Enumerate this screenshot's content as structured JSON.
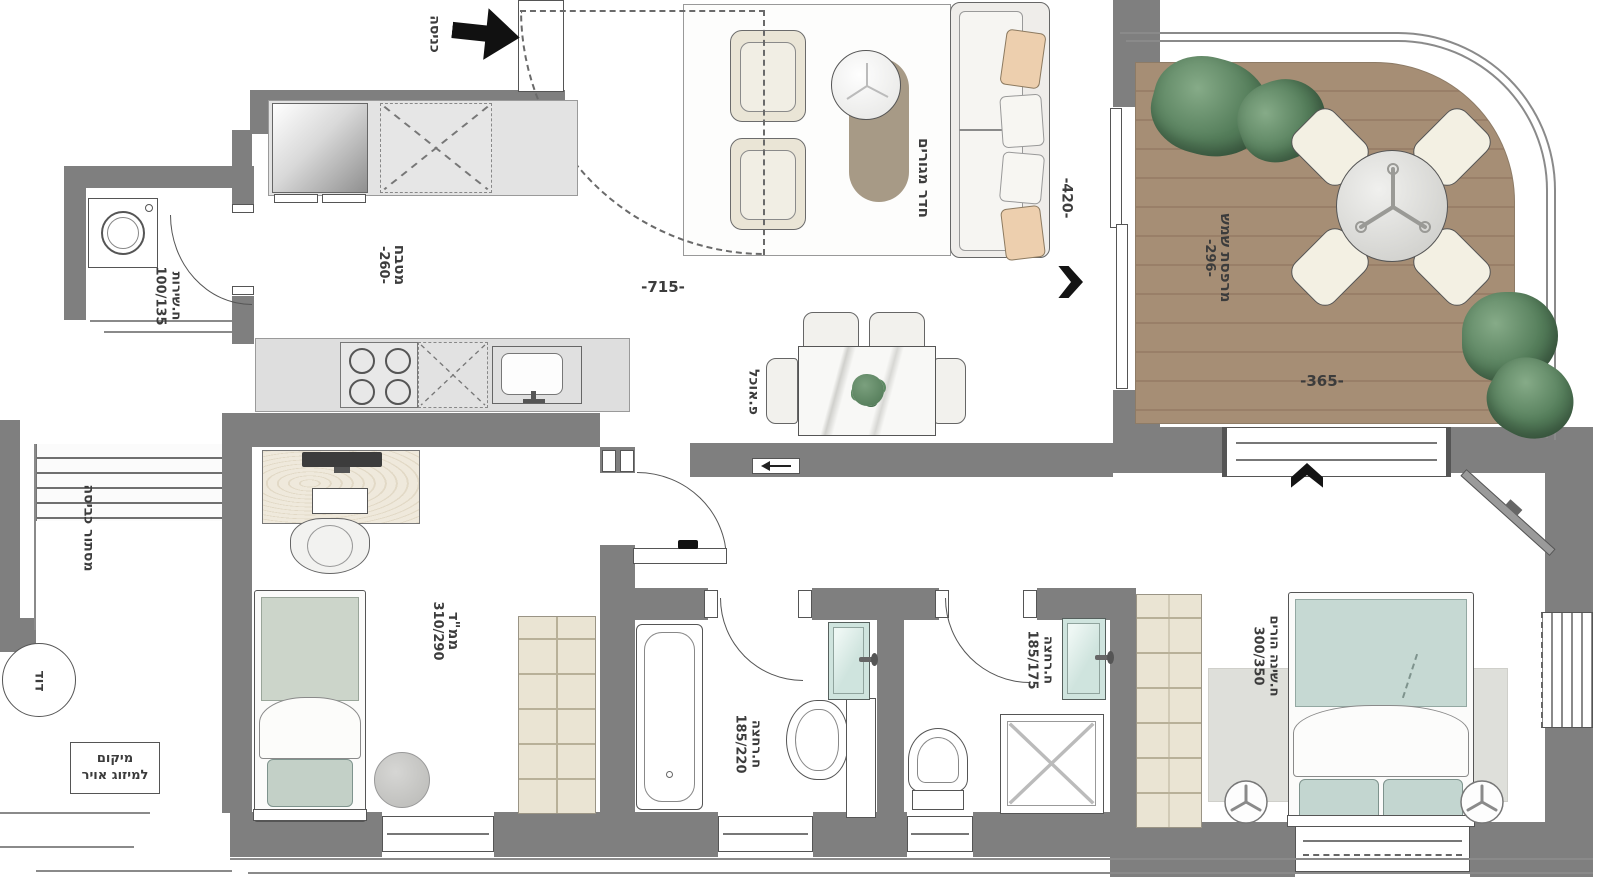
{
  "rooms": {
    "entrance": {
      "name": "כניסה"
    },
    "living": {
      "name": "חדר מגורים",
      "width_dim": "-715-",
      "depth_dim": "-420-"
    },
    "kitchen": {
      "name": "מטבח",
      "dim": "-260-"
    },
    "dining": {
      "name": "פ.אוכל"
    },
    "balcony": {
      "name": "מרפסת שמש",
      "depth_dim": "-296-",
      "width_dim": "-365-"
    },
    "service": {
      "name": "ח.שירות",
      "size": "100/135"
    },
    "laundry": {
      "name": "מסתור כביסה"
    },
    "boiler": {
      "name": "דוד"
    },
    "ac": {
      "line1": "מיקום",
      "line2": "למיזוג אויר"
    },
    "safe_room": {
      "name": "ממ\"ד",
      "size": "310/290"
    },
    "bath1": {
      "name": "ח.רחצה",
      "size": "185/220"
    },
    "bath2": {
      "name": "ח.רחצה",
      "size": "185/175"
    },
    "master": {
      "name": "ח.שינה הורים",
      "size": "300/350"
    }
  },
  "colors": {
    "wall": "#7f7f7f",
    "deck": "#a68e75",
    "teal_fixture": "#cfe4de",
    "plant_green": "#547d5a",
    "cushion_peach": "#edcfae"
  }
}
